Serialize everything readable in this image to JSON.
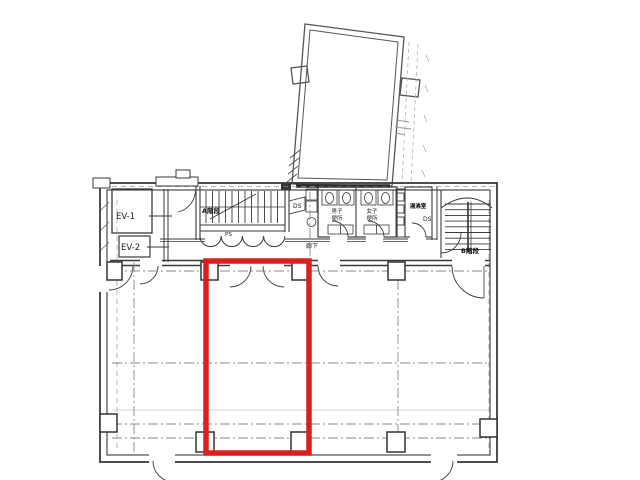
{
  "drawing": {
    "type": "floor-plan",
    "labels": {
      "elevator1": "EV-1",
      "elevator2": "EV-2",
      "stair_a": "A階段",
      "stair_b": "B階段",
      "duct_a": "DS",
      "duct_b": "DS",
      "pipe_shaft": "PS",
      "mens_toilet_line1": "男子",
      "mens_toilet_line2": "便所",
      "womens_toilet_line1": "女子",
      "womens_toilet_line2": "便所",
      "kitchenette": "湯沸室",
      "corridor": "廊下"
    },
    "colors": {
      "highlight": "#d9201c",
      "wall": "#3a3a3a",
      "centerline": "#8a8a8a",
      "background": "#ffffff"
    }
  }
}
